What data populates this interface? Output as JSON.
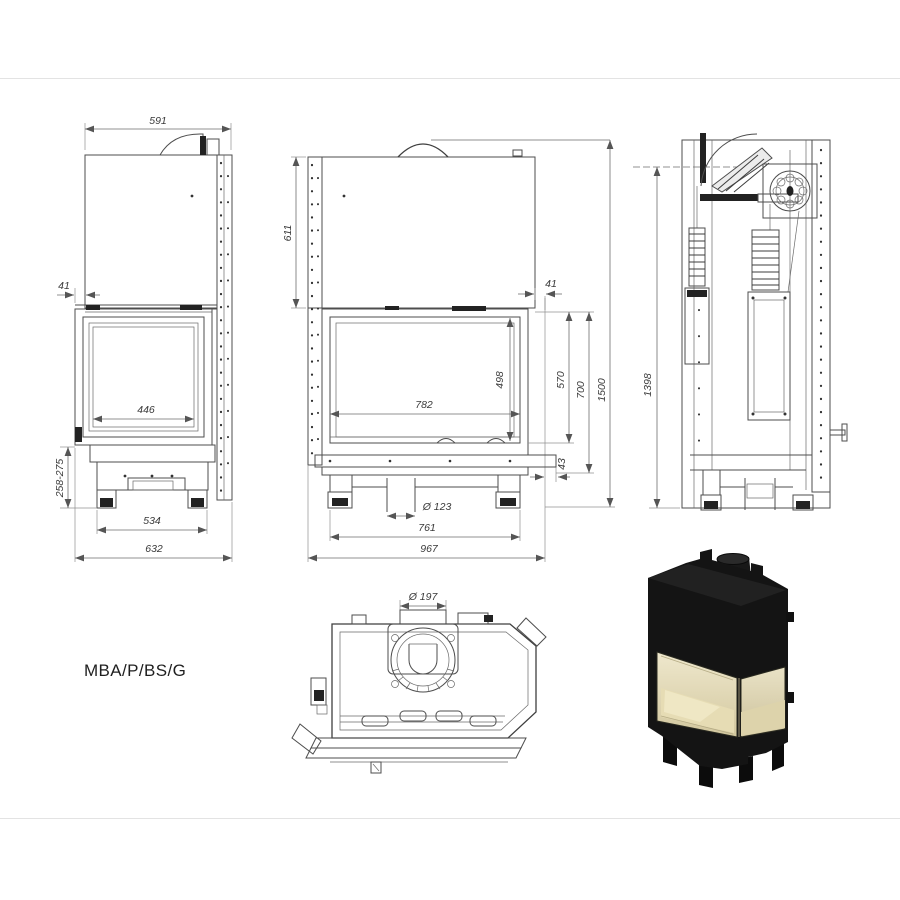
{
  "page": {
    "background": "#ffffff",
    "frame_line_color": "#e3e3e3",
    "drawing_line_color": "#4d4d4d",
    "dim_text_color": "#3a3a3a"
  },
  "drawing": {
    "model_label": "MBA/P/BS/G",
    "views": {
      "side_left": {
        "dim_top_width": "591",
        "dim_front_offset": "41",
        "dim_glass_width": "446",
        "dim_base_height": "258-275",
        "dim_feet_span": "534",
        "dim_total_depth": "632"
      },
      "front": {
        "dim_upper_height": "611",
        "dim_side_offset": "41",
        "dim_glass_width": "782",
        "dim_glass_height": "498",
        "dim_door_height": "570",
        "dim_body_height": "700",
        "dim_total_height": "1500",
        "dim_base_offset": "43",
        "dim_flue_bottom": "Ø 123",
        "dim_feet_span": "761",
        "dim_total_width": "967"
      },
      "side_right": {
        "dim_height": "1398"
      },
      "top": {
        "dim_flue_top": "Ø 197"
      }
    },
    "render": {
      "body_color": "#141414",
      "glass_interior_color": "#e3d9b4"
    }
  }
}
